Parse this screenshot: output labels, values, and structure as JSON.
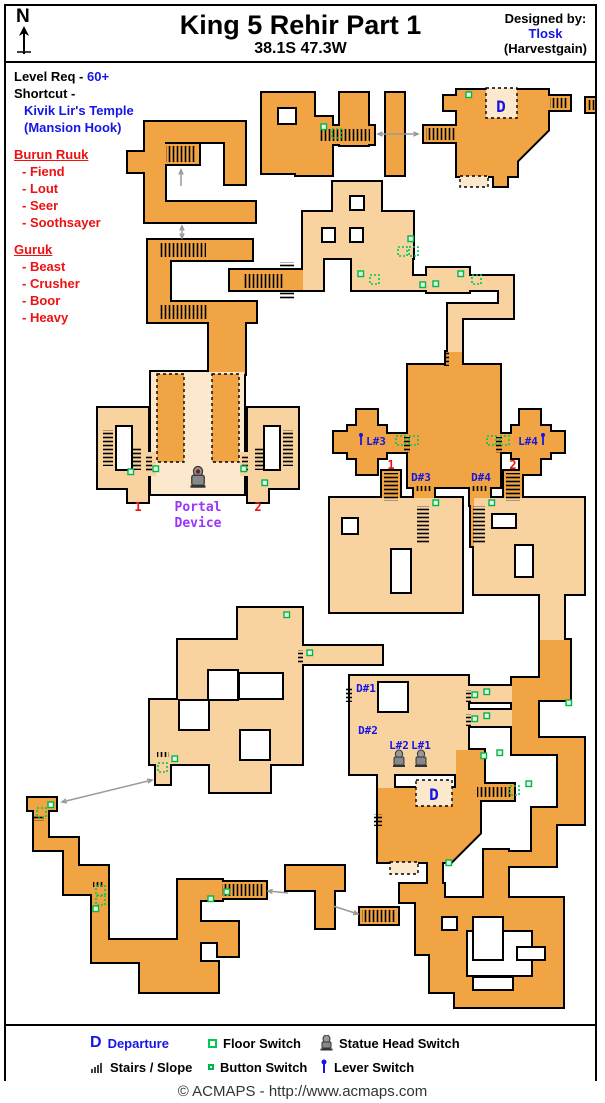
{
  "header": {
    "north_label": "N",
    "title": "King 5 Rehir Part 1",
    "coords": "38.1S 47.3W",
    "designed_by": "Designed by:",
    "designer": "Tlosk",
    "designer_alt": "(Harvestgain)"
  },
  "info": {
    "level_req_label": "Level Req -",
    "level_req_value": "60+",
    "shortcut_label": "Shortcut -",
    "shortcut_line1": "Kivik Lir's Temple",
    "shortcut_line2": "(Mansion Hook)",
    "factions": [
      {
        "name": "Burun Ruuk",
        "members": [
          "- Fiend",
          "- Lout",
          "- Seer",
          "- Soothsayer"
        ]
      },
      {
        "name": "Guruk",
        "members": [
          "- Beast",
          "- Crusher",
          "- Boor",
          "- Heavy"
        ]
      }
    ]
  },
  "map_labels": {
    "d_top": "D",
    "d_bottom": "D",
    "d1": "D#1",
    "d2": "D#2",
    "d3": "D#3",
    "d4": "D#4",
    "l1": "L#1",
    "l2": "L#2",
    "l3": "L#3",
    "l4": "L#4",
    "portal1": "Portal",
    "portal2": "Device",
    "num1a": "1",
    "num2a": "2",
    "num1b": "1",
    "num2b": "2"
  },
  "legend": {
    "items": [
      {
        "icon": "departure-icon",
        "label": "Departure"
      },
      {
        "icon": "floor-switch-icon",
        "label": "Floor Switch"
      },
      {
        "icon": "statue-head-switch-icon",
        "label": "Statue Head Switch"
      },
      {
        "icon": "stairs-icon",
        "label": "Stairs / Slope"
      },
      {
        "icon": "button-switch-icon",
        "label": "Button Switch"
      },
      {
        "icon": "lever-switch-icon",
        "label": "Lever Switch"
      }
    ]
  },
  "footer": {
    "text": "© ACMAPS - http://www.acmaps.com"
  },
  "colors": {
    "room_dark": "#F0A443",
    "room_light": "#F8D3A0",
    "room_pale": "#FCE8CC",
    "wall": "#000000",
    "label_blue": "#1515E6",
    "label_red": "#EE1111",
    "label_purple": "#9933FF",
    "switch_green": "#00C853",
    "button_fill": "#E4FFE9",
    "arrow_gray": "#999999",
    "statue_gray": "#999999"
  }
}
